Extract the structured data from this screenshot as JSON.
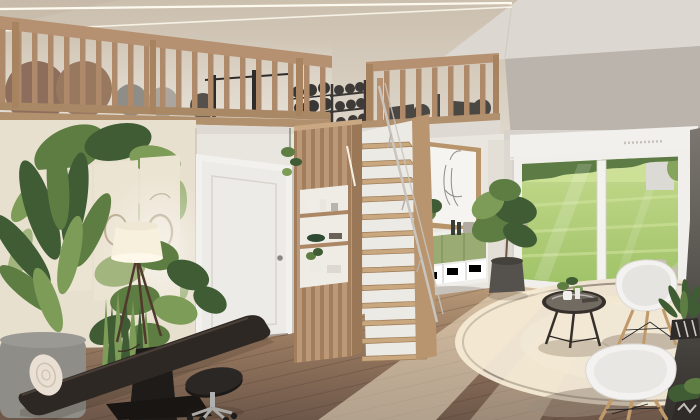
{
  "scene": {
    "type": "3d-interior-render",
    "setting": "loft living room with mezzanine home gym, wooden staircase and garden view",
    "no_text_visible": true,
    "objects": [
      "vaulted ceiling with two LED strip lights",
      "left mezzanine wood railing with exercise balls, barbell rack and weight plates",
      "right mezzanine wood railing with gym equipment silhouettes and dumbbell rack",
      "botanical mural wall with three abstract cream posters",
      "potted palm, snake plant and leafy foreground plants",
      "black tripod floor lamp with white drum shade",
      "white interior door with recessed panel",
      "slatted wood column with three open shelves holding vases, bowls and a plant",
      "steep open-riser wood staircase with thin handrail",
      "wood-framed line-art picture of hands",
      "floating sideboard with sage green doors and white open shelf with books",
      "tall potted plant in dark fabric planter",
      "white sliding glass door with roller shutter box",
      "garden view with lawn, hedge, white outbuilding and stepping stones",
      "wood plank floor with sunlight patches",
      "round cream rug with thin dark trim ring",
      "round black-framed glass coffee table with small plant and books",
      "two white shell armchairs with wooden dowel legs",
      "plant in black-and-white patterned pot",
      "black flat bench with rolled white towel",
      "black rolling stool with chrome base",
      "dark shaded wall corner at far right"
    ]
  },
  "colors": {
    "ceil_base_top": "#cbbfae",
    "ceil_base_bottom": "#e3ddd2",
    "ceiling_light": "#dcd7d0",
    "wall_upper_gray": "#bab4ac",
    "led": "#fffdf2",
    "mural_bg": "#e8e0cf",
    "poster": "#ece4d3",
    "poster_line": "#b9aa8e",
    "plant_dark": "#3f5c34",
    "plant_mid": "#5d7d43",
    "plant_light": "#7d9c58",
    "plant_pale": "#a3b57f",
    "wood_rail": "#b59172",
    "wood_baluster": "#ae8a6a",
    "wood_post": "#a8835f",
    "wood_slab": "#b1906e",
    "fascia": "#dedad3",
    "ball_brown": "#8d6e5c",
    "ball_brown2": "#98785f",
    "ball_gray": "#908c86",
    "ball_light": "#aba59d",
    "ball_dark": "#55504b",
    "gym_dark": "#3a3734",
    "wall_back": "#e9e6e0",
    "wall_window": "#d7d3cc",
    "door": "#edebe7",
    "door_frame": "#f3f1ee",
    "door_shadow": "#c8c4be",
    "wood_column": "#bb9878",
    "wood_column_dark": "#9a7757",
    "slat_dark": "#a37e5c",
    "shelf_bg": "#efece6",
    "wood_tread": "#c9a77f",
    "tread_edge": "#9b7a58",
    "wood_stringer": "#b8946f",
    "handrail": "#c9c5be",
    "art_frame": "#b7946a",
    "art_mat": "#f6f4f0",
    "art_line": "#8f8d89",
    "sb_white": "#f0eeea",
    "sb_green": "#9aab74",
    "sb_green_dark": "#7e9160",
    "bottle": "#3a3f35",
    "basket": "#b0aaa0",
    "shutter": "#f2f0ec",
    "window_frame": "#f1efeb",
    "grass_top": "#c6db90",
    "grass_bottom": "#9cc063",
    "grass_far": "#cfe29a",
    "hedge": "#5c7b45",
    "building": "#dcdad4",
    "stone": "#c6c0b2",
    "floor_far": "#bb9c7a",
    "floor_mid": "#96785f",
    "floor_near": "#6d5749",
    "sun": "#f7ecd2",
    "rug": "#eee3d0",
    "rug_ring": "#5f5347",
    "rug_shadow": "#a89a87",
    "chair_shell": "#f3f2f0",
    "chair_inner": "#e6e4e0",
    "chair_edge": "#d9d7d3",
    "wood_leg": "#c09a6b",
    "table_black": "#35302c",
    "glass_top": "#7b756c",
    "pot_gray": "#8f8d88",
    "pot_dark": "#55524e",
    "pot_black": "#2e2b29",
    "bench_black": "#2e2824",
    "bench_dark": "#1f1b19",
    "stool_black": "#2b2724",
    "chrome": "#b0b0ae",
    "towel": "#e9dfd3",
    "towel_line": "#cfc2b1",
    "lamp_shade": "#f7f0dd",
    "lamp_leg": "#503a2d",
    "dark_top": "#7b766f",
    "dark_bottom": "#33302d",
    "shadow": "rgba(45,32,22,0.18)"
  }
}
